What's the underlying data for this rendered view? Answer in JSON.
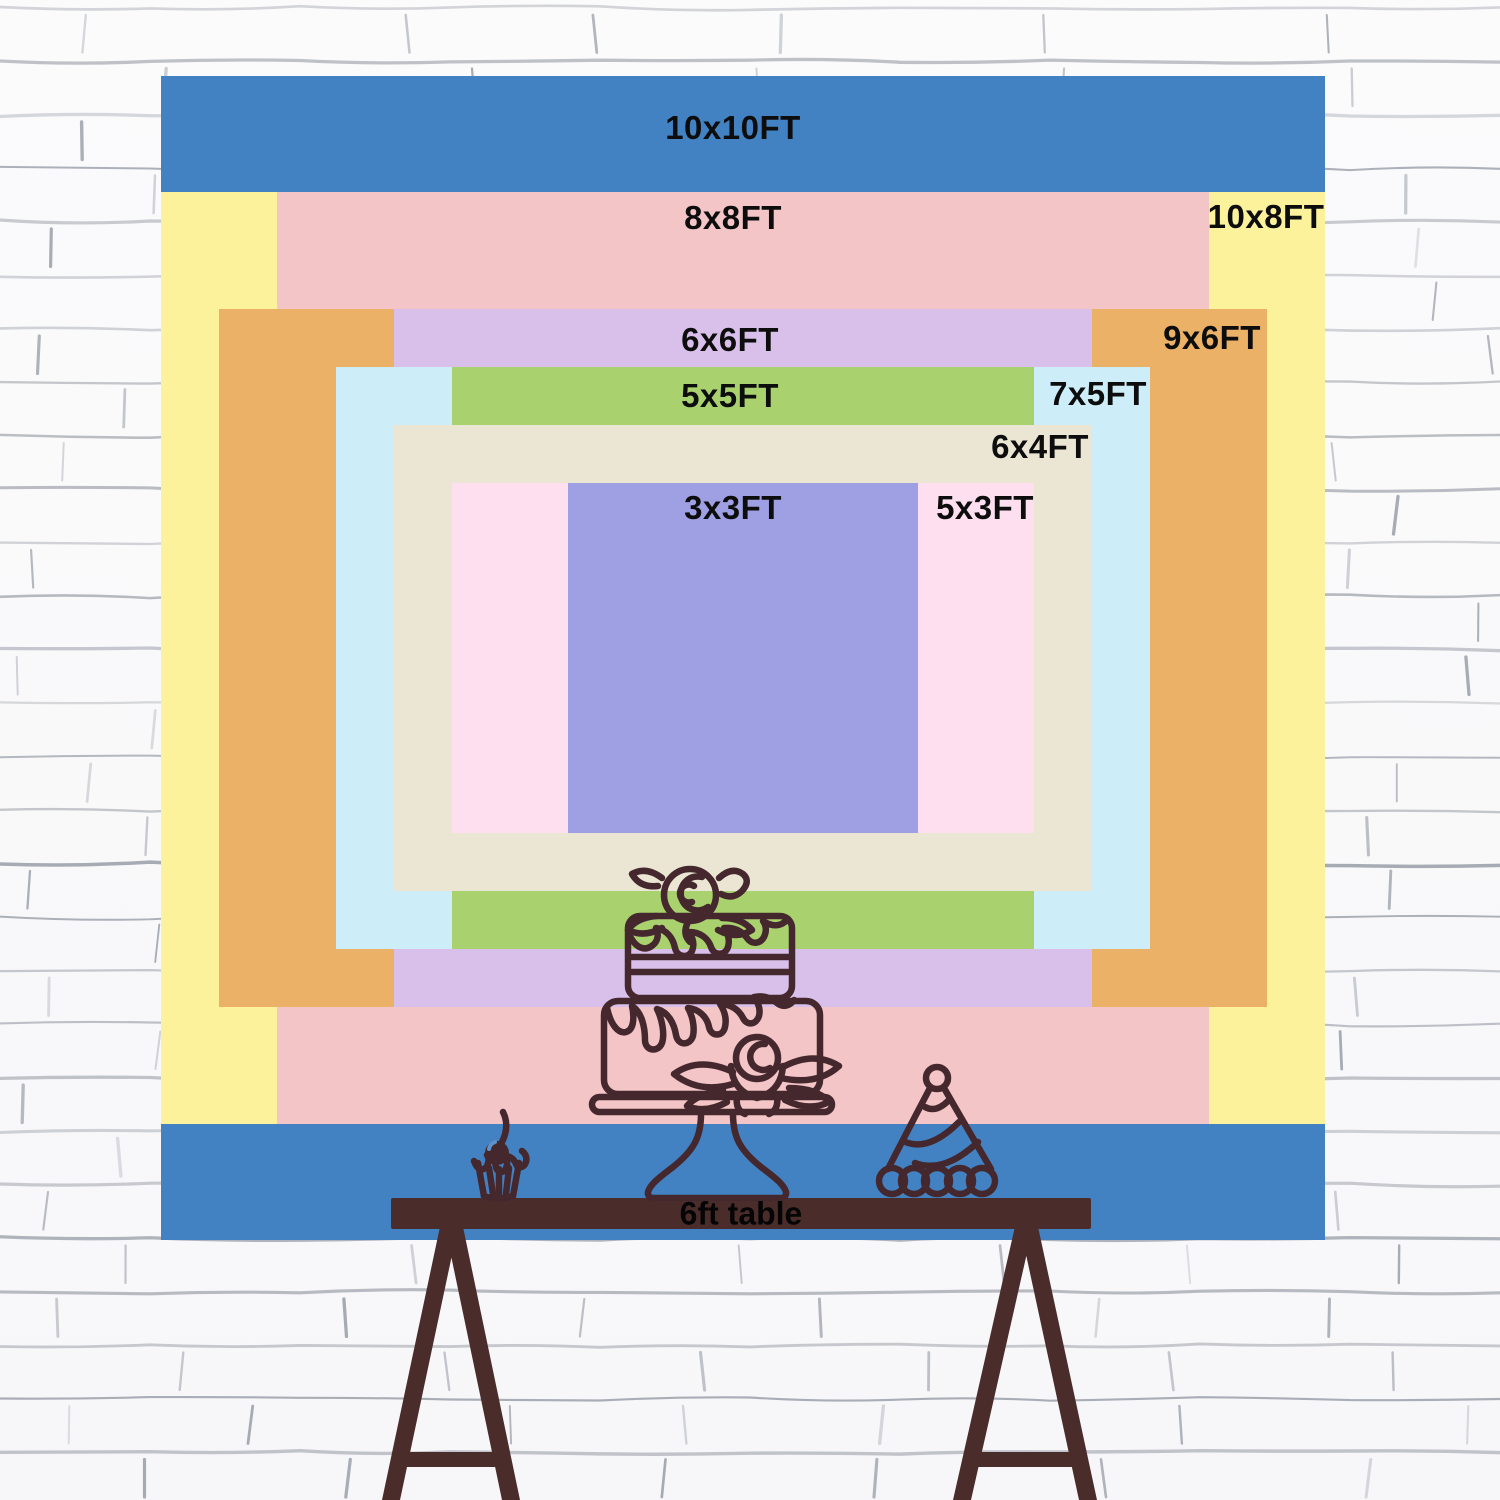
{
  "page": {
    "description": "Backdrop size comparison chart on white brick wall with 6ft table illustration"
  },
  "chart_data": {
    "type": "nested-size-diagram",
    "unit": "FT",
    "center_px": {
      "x": 743,
      "y": 658
    },
    "px_per_ft": 116.4,
    "note": "rectangles share a common center and are stacked largest-area to smallest",
    "sizes": [
      {
        "label": "10x10FT",
        "width_ft": 10,
        "height_ft": 10,
        "color": "#4282c2",
        "label_px": {
          "x": 733,
          "y": 128
        }
      },
      {
        "label": "10x8FT",
        "width_ft": 10,
        "height_ft": 8,
        "color": "#fbf29b",
        "label_px": {
          "x": 1266,
          "y": 217
        }
      },
      {
        "label": "8x8FT",
        "width_ft": 8,
        "height_ft": 8,
        "color": "#f3c5c7",
        "label_px": {
          "x": 733,
          "y": 218
        }
      },
      {
        "label": "9x6FT",
        "width_ft": 9,
        "height_ft": 6,
        "color": "#ebb166",
        "label_px": {
          "x": 1212,
          "y": 338
        }
      },
      {
        "label": "6x6FT",
        "width_ft": 6,
        "height_ft": 6,
        "color": "#d9c0ea",
        "label_px": {
          "x": 730,
          "y": 340
        }
      },
      {
        "label": "7x5FT",
        "width_ft": 7,
        "height_ft": 5,
        "color": "#cdeef8",
        "label_px": {
          "x": 1098,
          "y": 394
        }
      },
      {
        "label": "5x5FT",
        "width_ft": 5,
        "height_ft": 5,
        "color": "#a9d26f",
        "label_px": {
          "x": 730,
          "y": 396
        }
      },
      {
        "label": "6x4FT",
        "width_ft": 6,
        "height_ft": 4,
        "color": "#ebe6d3",
        "label_px": {
          "x": 1040,
          "y": 447
        }
      },
      {
        "label": "5x3FT",
        "width_ft": 5,
        "height_ft": 3,
        "color": "#fedff0",
        "label_px": {
          "x": 985,
          "y": 508
        }
      },
      {
        "label": "3x3FT",
        "width_ft": 3,
        "height_ft": 3,
        "color": "#9f9fe3",
        "label_px": {
          "x": 733,
          "y": 508
        }
      }
    ]
  },
  "table": {
    "label": "6ft table",
    "label_px": {
      "x": 741,
      "y": 1214
    },
    "wood_color": "#4a2d2b"
  },
  "artwork": {
    "stroke_color": "#45282e",
    "items": [
      "two-tier-cake-on-stand",
      "cupcake-with-cherry",
      "party-hat"
    ]
  },
  "wall": {
    "background": "#fbfbfc",
    "mortar_line_color": "#7c838e",
    "row_height_px": 53.5
  }
}
